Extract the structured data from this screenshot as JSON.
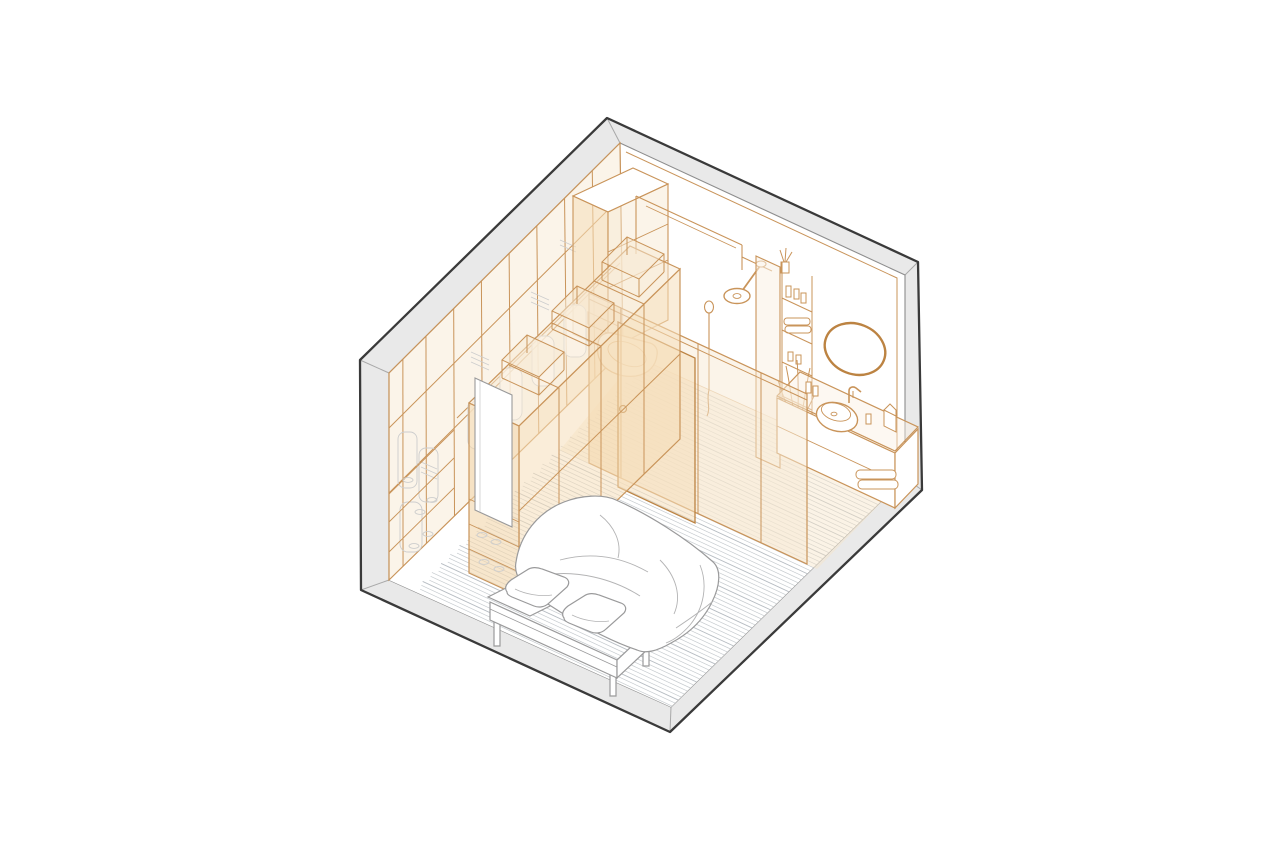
{
  "page": {
    "title": "Axonometric drawing of a bedroom with walk-in wardrobe and ensuite bathroom"
  },
  "canvas": {
    "width": 1280,
    "height": 853
  },
  "palette": {
    "background": "#ffffff",
    "outline": "#3a3a3a",
    "wallFill": "#e9e9e9",
    "wallInnerLine": "#8d8d8d",
    "miterLine": "#a8a8a8",
    "cornerLine": "#bdbdbd",
    "orangeLine": "#c9945a",
    "orangeStrong": "#bc8342",
    "orangeFillLight": "rgba(248,233,211,0.50)",
    "orangeFillMed": "rgba(245,222,185,0.55)",
    "orangeFillDeep": "rgba(242,214,172,0.62)",
    "bathFloorTint": "rgba(247,228,199,0.45)",
    "floorPlank": "#c6cbcf",
    "floorPlankDark": "#b6bcc2",
    "grayDetail": "#9a9a9b",
    "grayWrinkle": "#b3b3b4",
    "grayFaint": "#cdcdcd",
    "white": "#ffffff"
  },
  "scene": {
    "type": "axonometric-room-drawing",
    "room": "bedroom-with-ensuite-bathroom",
    "elements": [
      {
        "name": "room-shell",
        "desc": "gray wall and floor-slab band forming hexagonal silhouette"
      },
      {
        "name": "wood-floor",
        "desc": "white plank floor with diagonal plank lines"
      },
      {
        "name": "wardrobe-wall-row",
        "desc": "full-height wardrobe along back-left wall, orange translucent"
      },
      {
        "name": "wardrobe-peninsula",
        "desc": "freestanding wardrobe row forming walk-in corridor"
      },
      {
        "name": "corridor-door-panel",
        "desc": "white door / mirror panel at corridor end"
      },
      {
        "name": "hanging-clothes",
        "desc": "faint gray clothes on rail"
      },
      {
        "name": "shoe-shelves",
        "desc": "low shelves with shoes"
      },
      {
        "name": "glass-partition",
        "desc": "orange translucent glazed wall with sliding door"
      },
      {
        "name": "wall-hung-toilet",
        "desc": "white wall-hung WC with flush plate"
      },
      {
        "name": "shower",
        "desc": "ceiling arm rain shower head and hand shower"
      },
      {
        "name": "shelf-tower",
        "desc": "open shelves with toiletries, towels and diffuser"
      },
      {
        "name": "vanity",
        "desc": "wall-hung vanity cabinet with drawers and towels"
      },
      {
        "name": "vessel-sink",
        "desc": "round countertop basin with wall faucet"
      },
      {
        "name": "oval-mirror",
        "desc": "tilted oval mirror"
      },
      {
        "name": "plant",
        "desc": "potted grass plant"
      },
      {
        "name": "bed",
        "desc": "double bed with two pillows and draped duvet"
      }
    ]
  }
}
